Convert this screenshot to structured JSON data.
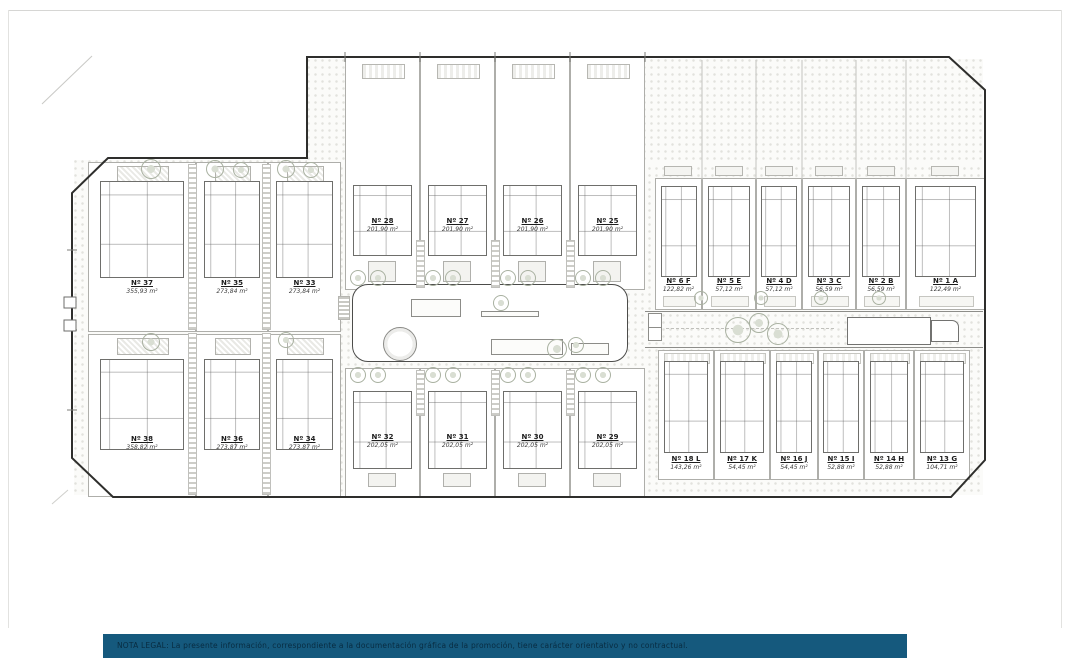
{
  "footer": {
    "bar_color": "#15597d",
    "legal_text": "NOTA LEGAL: La presente información, correspondiente a la documentación gráfica de la promoción, tiene carácter orientativo y no contractual."
  },
  "plan": {
    "description": "Residential site plan with numbered units and surface areas",
    "groups": [
      {
        "id": "left_top",
        "units": [
          {
            "label": "Nº 37",
            "area": "355,93 m²"
          },
          {
            "label": "Nº 35",
            "area": "273,84 m²"
          },
          {
            "label": "Nº 33",
            "area": "273,84 m²"
          }
        ]
      },
      {
        "id": "left_bottom",
        "units": [
          {
            "label": "Nº 38",
            "area": "358,82 m²"
          },
          {
            "label": "Nº 36",
            "area": "273,87 m²"
          },
          {
            "label": "Nº 34",
            "area": "273,87 m²"
          }
        ]
      },
      {
        "id": "mid_top",
        "units": [
          {
            "label": "Nº 28",
            "area": "201,90 m²"
          },
          {
            "label": "Nº 27",
            "area": "201,90 m²"
          },
          {
            "label": "Nº 26",
            "area": "201,90 m²"
          },
          {
            "label": "Nº 25",
            "area": "201,90 m²"
          }
        ]
      },
      {
        "id": "mid_bottom",
        "units": [
          {
            "label": "Nº 32",
            "area": "202,05 m²"
          },
          {
            "label": "Nº 31",
            "area": "202,05 m²"
          },
          {
            "label": "Nº 30",
            "area": "202,05 m²"
          },
          {
            "label": "Nº 29",
            "area": "202,05 m²"
          }
        ]
      },
      {
        "id": "right_top",
        "units": [
          {
            "label": "Nº 6 F",
            "area": "122,82 m²"
          },
          {
            "label": "Nº 5 E",
            "area": "57,12 m²"
          },
          {
            "label": "Nº 4 D",
            "area": "57,12 m²"
          },
          {
            "label": "Nº 3 C",
            "area": "56,59 m²"
          },
          {
            "label": "Nº 2 B",
            "area": "56,59 m²"
          },
          {
            "label": "Nº 1 A",
            "area": "122,49 m²"
          }
        ]
      },
      {
        "id": "right_bottom",
        "units": [
          {
            "label": "Nº 18 L",
            "area": "143,26 m²"
          },
          {
            "label": "Nº 17 K",
            "area": "54,45 m²"
          },
          {
            "label": "Nº 16 J",
            "area": "54,45 m²"
          },
          {
            "label": "Nº 15 I",
            "area": "52,88 m²"
          },
          {
            "label": "Nº 14 H",
            "area": "52,88 m²"
          },
          {
            "label": "Nº 13 G",
            "area": "104,71 m²"
          }
        ]
      }
    ]
  }
}
